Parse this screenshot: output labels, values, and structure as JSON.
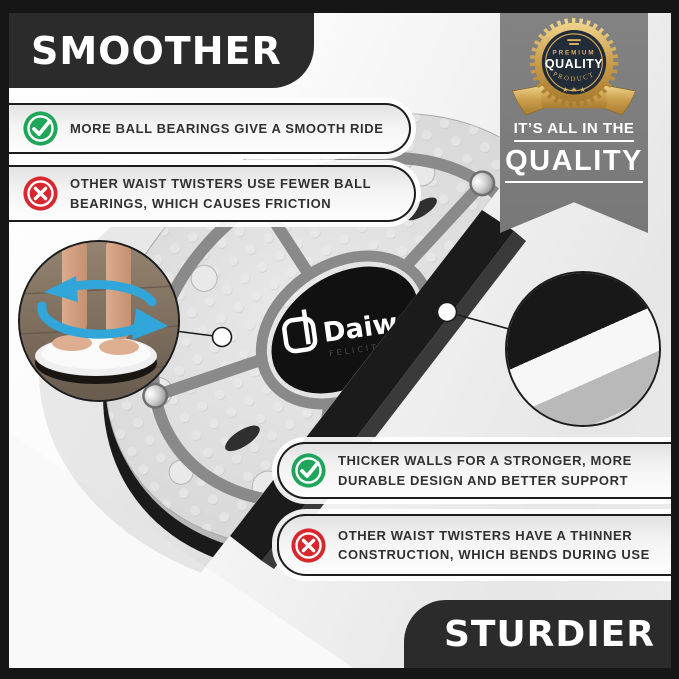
{
  "banners": {
    "top_label": "SMOOTHER",
    "bottom_label": "STURDIER"
  },
  "quality_ribbon": {
    "badge": {
      "premium": "PREMIUM",
      "quality": "QUALITY",
      "product": "PRODUCT",
      "stars": "★ ★ ★"
    },
    "tagline_line1": "IT’S ALL IN THE",
    "tagline_line2": "QUALITY"
  },
  "callouts": {
    "smooth_pro": {
      "icon": "check",
      "lines": [
        "MORE BALL BEARINGS GIVE A SMOOTH RIDE"
      ]
    },
    "smooth_con": {
      "icon": "cross",
      "lines": [
        "OTHER WAIST TWISTERS USE FEWER BALL",
        "BEARINGS, WHICH CAUSES FRICTION"
      ]
    },
    "sturdy_pro": {
      "icon": "check",
      "lines": [
        "THICKER WALLS FOR A STRONGER, MORE",
        "DURABLE DESIGN AND BETTER SUPPORT"
      ]
    },
    "sturdy_con": {
      "icon": "cross",
      "lines": [
        "OTHER WAIST TWISTERS HAVE A THINNER",
        "CONSTRUCTION, WHICH BENDS DURING USE"
      ]
    }
  },
  "product": {
    "brand": "Daiwa",
    "sub_brand": "FELICITY",
    "type": "waist twister balance disc"
  },
  "colors": {
    "check_green": "#1fa65a",
    "cross_red": "#d7282f",
    "banner_black": "#2c2b2b",
    "ribbon_gray": "#7d7d7d",
    "arrow_blue": "#31a6da",
    "badge_gold": "#d4aa54",
    "badge_navy": "#222b38"
  }
}
